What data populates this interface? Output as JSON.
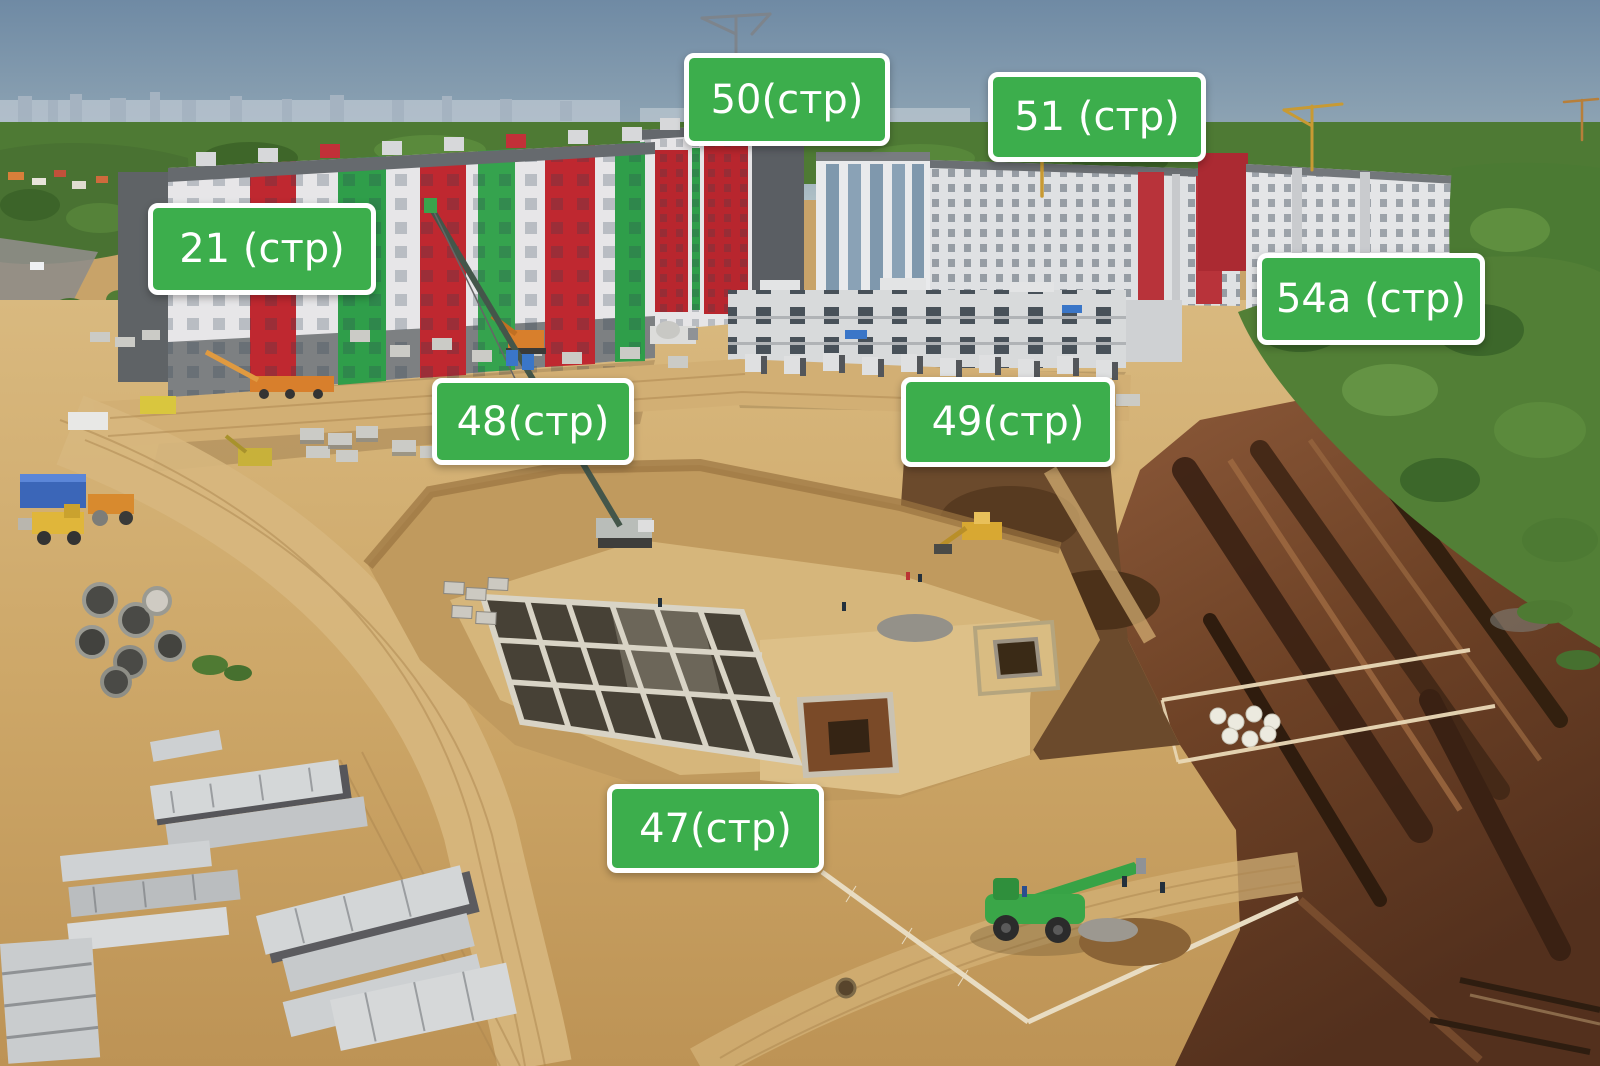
{
  "scene_type": "aerial-construction-site-photo",
  "colors": {
    "label_bg": "#3cae4c",
    "label_border": "#ffffff",
    "label_text": "#ffffff"
  },
  "labels": [
    {
      "id": "50",
      "text": "50(стр)"
    },
    {
      "id": "51",
      "text": "51 (стр)"
    },
    {
      "id": "21",
      "text": "21 (стр)"
    },
    {
      "id": "54a",
      "text": "54а (стр)"
    },
    {
      "id": "48",
      "text": "48(стр)"
    },
    {
      "id": "49",
      "text": "49(стр)"
    },
    {
      "id": "47",
      "text": "47(стр)"
    }
  ]
}
